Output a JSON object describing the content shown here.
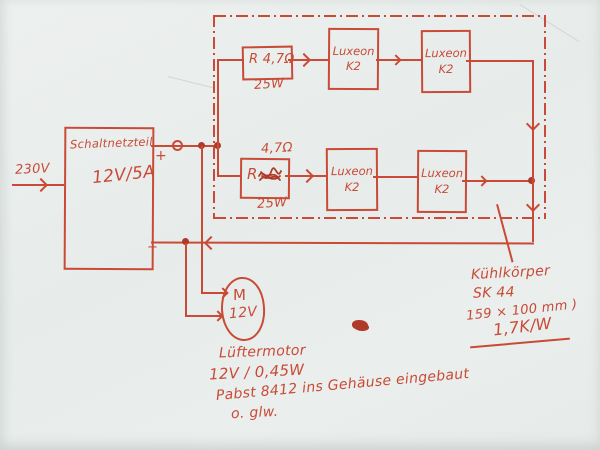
{
  "colors": {
    "ink": "#c94a36",
    "paper": "#e9edec"
  },
  "input": {
    "label": "230V"
  },
  "psu": {
    "title": "Schaltnetzteil",
    "rating": "12V/5A",
    "plus_label": "+",
    "minus_label": "−"
  },
  "led_array": {
    "rows": [
      {
        "resistor": {
          "label": "R 4,7Ω",
          "power": "25W"
        },
        "leds": [
          {
            "name": "Luxeon",
            "model": "K2"
          },
          {
            "name": "Luxeon",
            "model": "K2"
          }
        ]
      },
      {
        "resistor": {
          "label": "R",
          "value_note": "4,7Ω",
          "power": "25W"
        },
        "leds": [
          {
            "name": "Luxeon",
            "model": "K2"
          },
          {
            "name": "Luxeon",
            "model": "K2"
          }
        ]
      }
    ]
  },
  "fan_motor": {
    "symbol": "M",
    "voltage": "12V",
    "note_line1": "Lüftermotor",
    "note_line2": "12V / 0,45W",
    "note_line3": "Pabst 8412 ins Gehäuse eingebaut",
    "note_line4": "o. glw."
  },
  "heatsink": {
    "line1": "Kühlkörper",
    "line2": "SK 44",
    "line3": "159 × 100 mm )",
    "line4": "1,7K/W"
  }
}
